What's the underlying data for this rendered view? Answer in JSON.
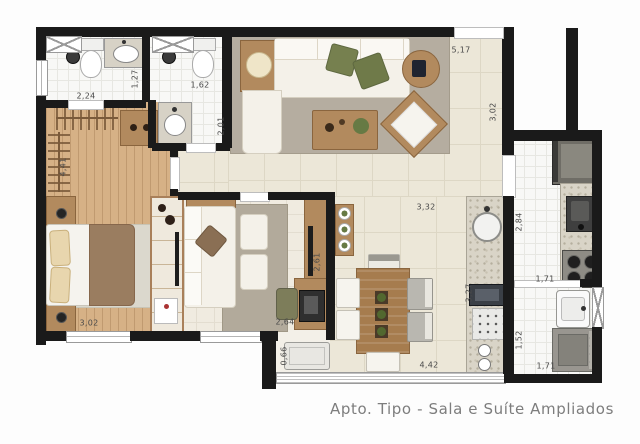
{
  "plan": {
    "caption": "Apto. Tipo - Sala e Suíte Ampliados",
    "dimensions": [
      {
        "value": "2,24",
        "x": 86,
        "y": 96,
        "rot": 0
      },
      {
        "value": "1,27",
        "x": 135,
        "y": 79,
        "rot": -90
      },
      {
        "value": "1,62",
        "x": 200,
        "y": 85,
        "rot": 0
      },
      {
        "value": "2,01",
        "x": 221,
        "y": 126,
        "rot": -90
      },
      {
        "value": "4,41",
        "x": 63,
        "y": 167,
        "rot": -90
      },
      {
        "value": "5,17",
        "x": 461,
        "y": 50,
        "rot": 0
      },
      {
        "value": "3,02",
        "x": 493,
        "y": 112,
        "rot": -90
      },
      {
        "value": "3,02",
        "x": 89,
        "y": 323,
        "rot": 0
      },
      {
        "value": "2,61",
        "x": 317,
        "y": 262,
        "rot": -90
      },
      {
        "value": "2,64",
        "x": 285,
        "y": 322,
        "rot": 0
      },
      {
        "value": "3,32",
        "x": 426,
        "y": 207,
        "rot": 0
      },
      {
        "value": "2,84",
        "x": 519,
        "y": 222,
        "rot": -90
      },
      {
        "value": "3,27",
        "x": 469,
        "y": 293,
        "rot": -90
      },
      {
        "value": "1,71",
        "x": 545,
        "y": 279,
        "rot": 0
      },
      {
        "value": "1,52",
        "x": 519,
        "y": 340,
        "rot": -90
      },
      {
        "value": "1,71",
        "x": 546,
        "y": 366,
        "rot": 0
      },
      {
        "value": "4,42",
        "x": 429,
        "y": 365,
        "rot": 0
      },
      {
        "value": "0,66",
        "x": 284,
        "y": 356,
        "rot": -90
      }
    ],
    "colors": {
      "wall": "#1a1a1a",
      "wood": "#d6b186",
      "cream": "#ece7d8",
      "tile": "#f8f8f6",
      "granite": "#d9d4c7",
      "rug": "#b5ada0",
      "sofa": "#f4f1e9",
      "wood-f": "#b28a5e",
      "green": "#76804f",
      "caption": "#7d7d7d",
      "dim": "#4a4a4a"
    }
  }
}
